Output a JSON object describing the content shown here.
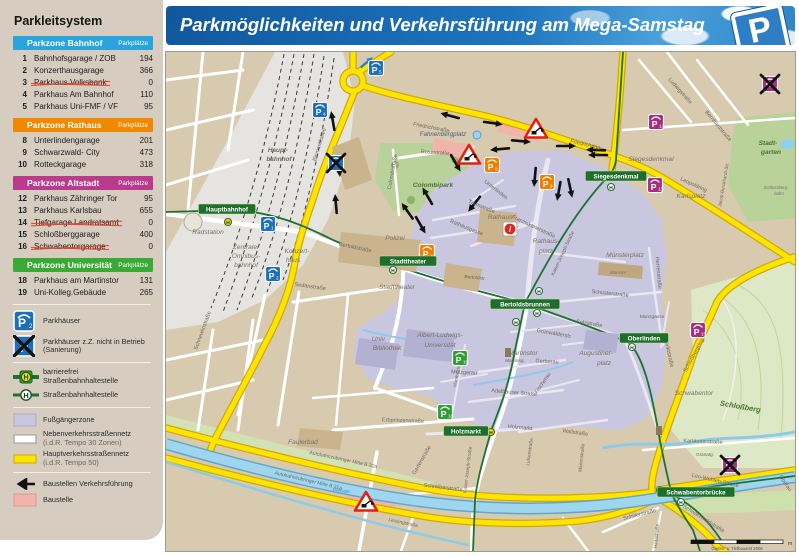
{
  "header": {
    "title": "Parkmöglichkeiten und Verkehrsführung am Mega-Samstag",
    "logo_letter": "P"
  },
  "sidebar": {
    "title": "Parkleitsystem",
    "parkplatze_label": "Parkplätze",
    "zones": [
      {
        "name": "Parkzone Bahnhof",
        "color": "#2aa4dd",
        "rows": [
          {
            "num": "1",
            "name": "Bahnhofsgarage / ZOB",
            "count": "194",
            "closed": false
          },
          {
            "num": "2",
            "name": "Konzerthausgarage",
            "count": "366",
            "closed": false
          },
          {
            "num": "3",
            "name": "Parkhaus Volksbank",
            "count": "0",
            "closed": true
          },
          {
            "num": "4",
            "name": "Parkhaus Am Bahnhof",
            "count": "110",
            "closed": false
          },
          {
            "num": "5",
            "name": "Parkhaus Uni-FMF / VF",
            "count": "95",
            "closed": false
          }
        ]
      },
      {
        "name": "Parkzone Rathaus",
        "color": "#f08900",
        "rows": [
          {
            "num": "8",
            "name": "Unterlindengarage",
            "count": "201",
            "closed": false
          },
          {
            "num": "9",
            "name": "Schwarzwald- City",
            "count": "473",
            "closed": false
          },
          {
            "num": "10",
            "name": "Rotteckgarage",
            "count": "318",
            "closed": false
          }
        ]
      },
      {
        "name": "Parkzone Altstadt",
        "color": "#b93b8c",
        "rows": [
          {
            "num": "12",
            "name": "Parkhaus Zähringer Tor",
            "count": "95",
            "closed": false
          },
          {
            "num": "13",
            "name": "Parkhaus Karlsbau",
            "count": "655",
            "closed": false
          },
          {
            "num": "14",
            "name": "Tiefgarage Landratsamt",
            "count": "0",
            "closed": true
          },
          {
            "num": "15",
            "name": "Schloßberggarage",
            "count": "400",
            "closed": false
          },
          {
            "num": "16",
            "name": "Schwabentorgarage",
            "count": "0",
            "closed": true
          }
        ]
      },
      {
        "name": "Parkzone Universität",
        "color": "#3aaa35",
        "rows": [
          {
            "num": "18",
            "name": "Parkhaus am Martinstor",
            "count": "131",
            "closed": false
          },
          {
            "num": "19",
            "name": "Uni-Kolleg.Gebäude",
            "count": "265",
            "closed": false
          }
        ]
      }
    ],
    "legend": [
      {
        "icon": "parkhaus",
        "label": "Parkhäuser"
      },
      {
        "icon": "parkhaus_closed",
        "label": "Parkhäuser z.Z. nicht in Betrieb (Sanierung)"
      },
      {
        "divider": true
      },
      {
        "icon": "tram_acc",
        "label": "barrierefrei Straßenbahnhaltestelle"
      },
      {
        "icon": "tram",
        "label": "Straßenbahnhaltestelle"
      },
      {
        "divider": true
      },
      {
        "icon": "ped",
        "label": "Fußgängerzone"
      },
      {
        "icon": "minor",
        "label": "Nebenverkehrsstraßennetz",
        "sub": "(i.d.R. Tempo 30 Zonen)"
      },
      {
        "icon": "major",
        "label": "Hauptverkehrsstraßennetz",
        "sub": "(i.d.R. Tempo 50)"
      },
      {
        "divider": true
      },
      {
        "icon": "arrow",
        "label": "Baustellen Verkehrsführung"
      },
      {
        "icon": "construction",
        "label": "Baustelle"
      }
    ]
  },
  "map": {
    "marker_colors": {
      "b": "#1d6fb8",
      "r": "#ef7d00",
      "a": "#a3307e",
      "u": "#2f9e36"
    },
    "parkings": [
      {
        "n": "1",
        "x": 265,
        "y": 224,
        "z": "b"
      },
      {
        "n": "2",
        "x": 270,
        "y": 274,
        "z": "b"
      },
      {
        "n": "3",
        "x": 333,
        "y": 163,
        "z": "b",
        "c": 1
      },
      {
        "n": "4",
        "x": 317,
        "y": 110,
        "z": "b"
      },
      {
        "n": "5",
        "x": 373,
        "y": 68,
        "z": "b"
      },
      {
        "n": "8",
        "x": 489,
        "y": 165,
        "z": "r"
      },
      {
        "n": "9",
        "x": 544,
        "y": 182,
        "z": "r"
      },
      {
        "n": "10",
        "x": 424,
        "y": 252,
        "z": "r"
      },
      {
        "n": "12",
        "x": 653,
        "y": 122,
        "z": "a"
      },
      {
        "n": "13",
        "x": 652,
        "y": 185,
        "z": "a"
      },
      {
        "n": "14",
        "x": 767,
        "y": 84,
        "z": "a",
        "c": 1
      },
      {
        "n": "15",
        "x": 695,
        "y": 330,
        "z": "a"
      },
      {
        "n": "16",
        "x": 727,
        "y": 465,
        "z": "a",
        "c": 1
      },
      {
        "n": "18",
        "x": 442,
        "y": 412,
        "z": "u"
      },
      {
        "n": "19",
        "x": 457,
        "y": 358,
        "z": "u"
      }
    ],
    "tram_stops": [
      {
        "t": "Hauptbahnhof",
        "x": 224,
        "y": 209
      },
      {
        "t": "Stadttheater",
        "x": 405,
        "y": 261
      },
      {
        "t": "Bertoldsbrunnen",
        "x": 522,
        "y": 304
      },
      {
        "t": "Siegesdenkmal",
        "x": 613,
        "y": 176
      },
      {
        "t": "Oberlinden",
        "x": 641,
        "y": 338
      },
      {
        "t": "Holzmarkt",
        "x": 463,
        "y": 431
      },
      {
        "t": "Schwabentorbrücke",
        "x": 693,
        "y": 492
      }
    ],
    "h_stops": [
      [
        225,
        222,
        1
      ],
      [
        390,
        270,
        0
      ],
      [
        536,
        291,
        0
      ],
      [
        534,
        313,
        0
      ],
      [
        513,
        322,
        0
      ],
      [
        608,
        187,
        0
      ],
      [
        629,
        347,
        0
      ],
      [
        488,
        432,
        1
      ],
      [
        657,
        490,
        0
      ],
      [
        678,
        502,
        0
      ]
    ],
    "place_labels": [
      {
        "t": "Haupt-",
        "x": 275,
        "y": 152,
        "c": "tstation",
        "s": 6.4
      },
      {
        "t": "bahnhof",
        "x": 276,
        "y": 161,
        "c": "tstation",
        "s": 6.4
      },
      {
        "t": "Radstation",
        "x": 205,
        "y": 234,
        "c": "tplace"
      },
      {
        "t": "Zentraler",
        "x": 243,
        "y": 249,
        "c": "tplace"
      },
      {
        "t": "Omnibus-",
        "x": 243,
        "y": 258,
        "c": "tplace"
      },
      {
        "t": "bahnhof",
        "x": 243,
        "y": 267,
        "c": "tplace"
      },
      {
        "t": "Konzert-",
        "x": 294,
        "y": 253,
        "c": "tplace"
      },
      {
        "t": "haus",
        "x": 290,
        "y": 262,
        "c": "tplace"
      },
      {
        "t": "Stadttheater",
        "x": 394,
        "y": 289,
        "c": "tplace"
      },
      {
        "t": "Polizei",
        "x": 392,
        "y": 240,
        "c": "tplace"
      },
      {
        "t": "Univ.",
        "x": 376,
        "y": 341,
        "c": "tplace"
      },
      {
        "t": "Bibliothek",
        "x": 384,
        "y": 350,
        "c": "tplace"
      },
      {
        "t": "Albert-Ludwigs-",
        "x": 437,
        "y": 337,
        "c": "tplace"
      },
      {
        "t": "Universität",
        "x": 437,
        "y": 347,
        "c": "tplace"
      },
      {
        "t": "Martinstor",
        "x": 520,
        "y": 355,
        "c": "tplace"
      },
      {
        "t": "Augustiner-",
        "x": 593,
        "y": 355,
        "c": "tplace"
      },
      {
        "t": "platz",
        "x": 601,
        "y": 365,
        "c": "tplace"
      },
      {
        "t": "Rathaus",
        "x": 497,
        "y": 219,
        "c": "tplace"
      },
      {
        "t": "Rathaus-",
        "x": 543,
        "y": 243,
        "c": "tplace"
      },
      {
        "t": "platz",
        "x": 543,
        "y": 253,
        "c": "tplace"
      },
      {
        "t": "Münsterplatz",
        "x": 622,
        "y": 257,
        "c": "tplace"
      },
      {
        "t": "Münster",
        "x": 615,
        "y": 274,
        "c": "tplace",
        "s": 4.5
      },
      {
        "t": "Fahnenbergplatz",
        "x": 440,
        "y": 136,
        "c": "tplatz",
        "s": 6.2
      },
      {
        "t": "Colombipark",
        "x": 430,
        "y": 187,
        "c": "tpark"
      },
      {
        "t": "Stadt-",
        "x": 765,
        "y": 145,
        "c": "tpark"
      },
      {
        "t": "garten",
        "x": 768,
        "y": 154,
        "c": "tpark"
      },
      {
        "t": "Schloßberg",
        "x": 737,
        "y": 409,
        "c": "tpark",
        "r": 10,
        "s": 7.5
      },
      {
        "t": "Schlossberg-",
        "x": 773,
        "y": 189,
        "c": "tplace",
        "s": 4.3
      },
      {
        "t": "bahn",
        "x": 776,
        "y": 195,
        "c": "tplace",
        "s": 4.3
      },
      {
        "t": "Siegesdenkmal",
        "x": 648,
        "y": 161,
        "c": "tplace"
      },
      {
        "t": "Karlsplatz",
        "x": 688,
        "y": 198,
        "c": "tplace"
      },
      {
        "t": "Schwabentor",
        "x": 691,
        "y": 395,
        "c": "tplace"
      },
      {
        "t": "Faulerbad",
        "x": 300,
        "y": 444,
        "c": "tplace"
      },
      {
        "t": "Dreisam",
        "x": 338,
        "y": 492,
        "c": "twater",
        "s": 4.6,
        "r": 8
      }
    ],
    "street_labels": [
      {
        "t": "Friedrichstraße",
        "x": 428,
        "y": 129,
        "r": 11
      },
      {
        "t": "Friedrichring",
        "x": 582,
        "y": 146,
        "r": 13
      },
      {
        "t": "Leopoldring",
        "x": 690,
        "y": 186,
        "r": 25
      },
      {
        "t": "Bismarckallee",
        "x": 318,
        "y": 145,
        "r": -73
      },
      {
        "t": "Rosastraße",
        "x": 432,
        "y": 154,
        "r": 3
      },
      {
        "t": "Colombistraße",
        "x": 391,
        "y": 172,
        "r": -80
      },
      {
        "t": "Ludwigstraße",
        "x": 676,
        "y": 92,
        "r": 48
      },
      {
        "t": "Bernhardstraße",
        "x": 714,
        "y": 127,
        "r": 50
      },
      {
        "t": "Jacob-Burckhardt-Str.",
        "x": 722,
        "y": 185,
        "r": -80,
        "s": 4.6
      },
      {
        "t": "Bertoldstraße",
        "x": 352,
        "y": 249,
        "r": 12
      },
      {
        "t": "Sedanstraße",
        "x": 307,
        "y": 288,
        "r": 8
      },
      {
        "t": "Bertoldstr.",
        "x": 472,
        "y": 279,
        "r": 5,
        "s": 4.8
      },
      {
        "t": "Schnewlinstraße",
        "x": 201,
        "y": 331,
        "r": -70
      },
      {
        "t": "Kaiser-Joseph-Straße",
        "x": 561,
        "y": 254,
        "r": -65,
        "s": 5
      },
      {
        "t": "Rathausgasse",
        "x": 463,
        "y": 229,
        "r": 22
      },
      {
        "t": "Turmstraße",
        "x": 478,
        "y": 208,
        "r": 22
      },
      {
        "t": "Unterlinden",
        "x": 492,
        "y": 191,
        "r": 38
      },
      {
        "t": "Franziskanerstraße",
        "x": 530,
        "y": 228,
        "r": 25
      },
      {
        "t": "Schusterstraße",
        "x": 607,
        "y": 295,
        "r": 6
      },
      {
        "t": "Herrenstraße",
        "x": 654,
        "y": 273,
        "r": 85
      },
      {
        "t": "Münzgasse",
        "x": 649,
        "y": 318,
        "s": 4.8
      },
      {
        "t": "Konviktstraße",
        "x": 664,
        "y": 351,
        "r": 78
      },
      {
        "t": "Salzstraße",
        "x": 586,
        "y": 325,
        "r": 9
      },
      {
        "t": "Grünwälderstr.",
        "x": 551,
        "y": 335,
        "r": 10
      },
      {
        "t": "Gerberau",
        "x": 544,
        "y": 363,
        "r": 3
      },
      {
        "t": "Martinsg.",
        "x": 512,
        "y": 362,
        "s": 4.8
      },
      {
        "t": "Metzgerau",
        "x": 461,
        "y": 374,
        "r": 3
      },
      {
        "t": "Fischerau",
        "x": 541,
        "y": 384,
        "r": -55
      },
      {
        "t": "Adelhauser Straße",
        "x": 511,
        "y": 394,
        "r": 5
      },
      {
        "t": "Wallstraße",
        "x": 572,
        "y": 434,
        "r": 8
      },
      {
        "t": "Holzmarkt",
        "x": 517,
        "y": 429,
        "r": 5
      },
      {
        "t": "Erbprinzenstraße",
        "x": 400,
        "y": 422,
        "r": 2
      },
      {
        "t": "Gartenstraße",
        "x": 420,
        "y": 461,
        "r": -60
      },
      {
        "t": "Humboldtstr.",
        "x": 456,
        "y": 374,
        "r": -78,
        "s": 4.8
      },
      {
        "t": "Kaiser-Joseph-Straße",
        "x": 466,
        "y": 470,
        "r": -83,
        "s": 4.8
      },
      {
        "t": "Luisenstraße",
        "x": 528,
        "y": 452,
        "r": -82,
        "s": 4.8
      },
      {
        "t": "Marienstraße",
        "x": 580,
        "y": 458,
        "r": -84,
        "s": 4.8
      },
      {
        "t": "Autobahnzubringer Mitte B 31a",
        "x": 340,
        "y": 461,
        "r": 12,
        "s": 5
      },
      {
        "t": "Autobahnzubringer Mitte B 31a",
        "x": 305,
        "y": 482,
        "r": 13,
        "s": 5
      },
      {
        "t": "Schreiberstraße",
        "x": 440,
        "y": 489,
        "r": 7
      },
      {
        "t": "Lessingstraße",
        "x": 400,
        "y": 524,
        "r": 12,
        "s": 4.8
      },
      {
        "t": "Kartäuserstraße",
        "x": 700,
        "y": 443,
        "r": 2
      },
      {
        "t": "Leo-Wohleb-Straße",
        "x": 712,
        "y": 482,
        "r": 13
      },
      {
        "t": "Granatg.",
        "x": 702,
        "y": 456,
        "s": 4.6
      },
      {
        "t": "Oberau",
        "x": 781,
        "y": 484,
        "r": 55
      },
      {
        "t": "Schwarzwaldstraße",
        "x": 700,
        "y": 520,
        "r": 32
      },
      {
        "t": "Schillerstraße",
        "x": 637,
        "y": 516,
        "r": -14
      },
      {
        "t": "Hildastraße",
        "x": 655,
        "y": 536,
        "r": -85,
        "s": 4.8
      },
      {
        "t": "Schloßbergring",
        "x": 692,
        "y": 356,
        "r": -62
      }
    ],
    "triangles": [
      [
        466,
        155
      ],
      [
        533,
        129
      ],
      [
        363,
        502
      ]
    ],
    "arrows": [
      [
        448,
        116,
        195
      ],
      [
        489,
        123,
        8
      ],
      [
        498,
        149,
        175
      ],
      [
        517,
        141,
        5
      ],
      [
        562,
        146,
        0
      ],
      [
        594,
        150,
        182
      ],
      [
        532,
        176,
        95
      ],
      [
        567,
        187,
        78
      ],
      [
        472,
        203,
        128
      ],
      [
        425,
        197,
        240
      ],
      [
        405,
        212,
        235
      ],
      [
        417,
        224,
        60
      ],
      [
        330,
        122,
        260
      ],
      [
        336,
        166,
        85
      ],
      [
        333,
        205,
        265
      ],
      [
        596,
        155,
        180
      ],
      [
        556,
        190,
        100
      ],
      [
        452,
        162,
        60
      ]
    ],
    "blue_arrow": [
      363,
      63,
      -40
    ],
    "info_point": [
      507,
      229
    ],
    "platz_dot": [
      474,
      135
    ],
    "scale": {
      "credit": "Garten- u. Tiefbauamt 2008",
      "unit": "m"
    }
  }
}
